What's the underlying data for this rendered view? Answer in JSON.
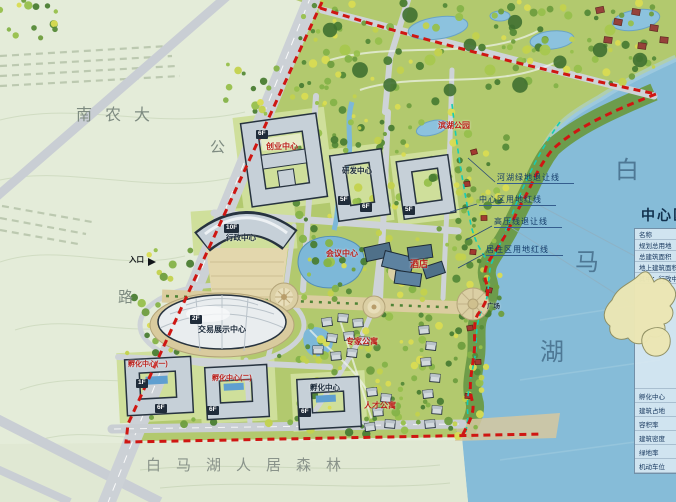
{
  "labels": {
    "university": "南农大",
    "road_top": "公",
    "road_bottom": "路",
    "entrance": "入口",
    "entrance_arrow": "►",
    "lake_1": "白",
    "lake_2": "马",
    "lake_3": "湖",
    "forest": "白马湖人居森林",
    "plaza": "广场",
    "buildings": {
      "startup": "创业中心",
      "rnd": "研发中心",
      "admin": "行政中心",
      "expo": "交易展示中心",
      "conference": "会议中心",
      "hotel": "酒店",
      "lakeside_park": "滨湖公园",
      "incubator_1": "孵化中心(一)",
      "incubator_2": "孵化中心(二)",
      "incubator_3": "孵化中心",
      "expert_apartments": "专家公寓",
      "talent_apartments": "人才公寓"
    },
    "tags": {
      "t1": "6F",
      "t2": "5F",
      "t3": "6F",
      "t4": "5F",
      "t5": "10F",
      "t6": "2F",
      "t7": "1F",
      "t8": "6F",
      "t9": "6F",
      "t10": "6F"
    },
    "callouts": {
      "c1": "河湖绿地退让线",
      "c2": "中心区用地红线",
      "c3": "高压线退让线",
      "c4": "居住区用地红线"
    }
  },
  "legend": {
    "title": "中心区经济技术指标",
    "rows": [
      "名称",
      "规划总用地",
      "总建筑面积",
      "地上建筑面积",
      "其中：行政中心",
      "孵化中心",
      "建筑占地",
      "容积率",
      "建筑密度",
      "绿地率",
      "机动车位"
    ]
  },
  "colors": {
    "boundary_red": "#cf1612",
    "setback_cyan": "#17cdb4",
    "lake_blue": "#86bcd8",
    "farmland": "#e4ecd9",
    "site_green": "#b2c96e"
  }
}
